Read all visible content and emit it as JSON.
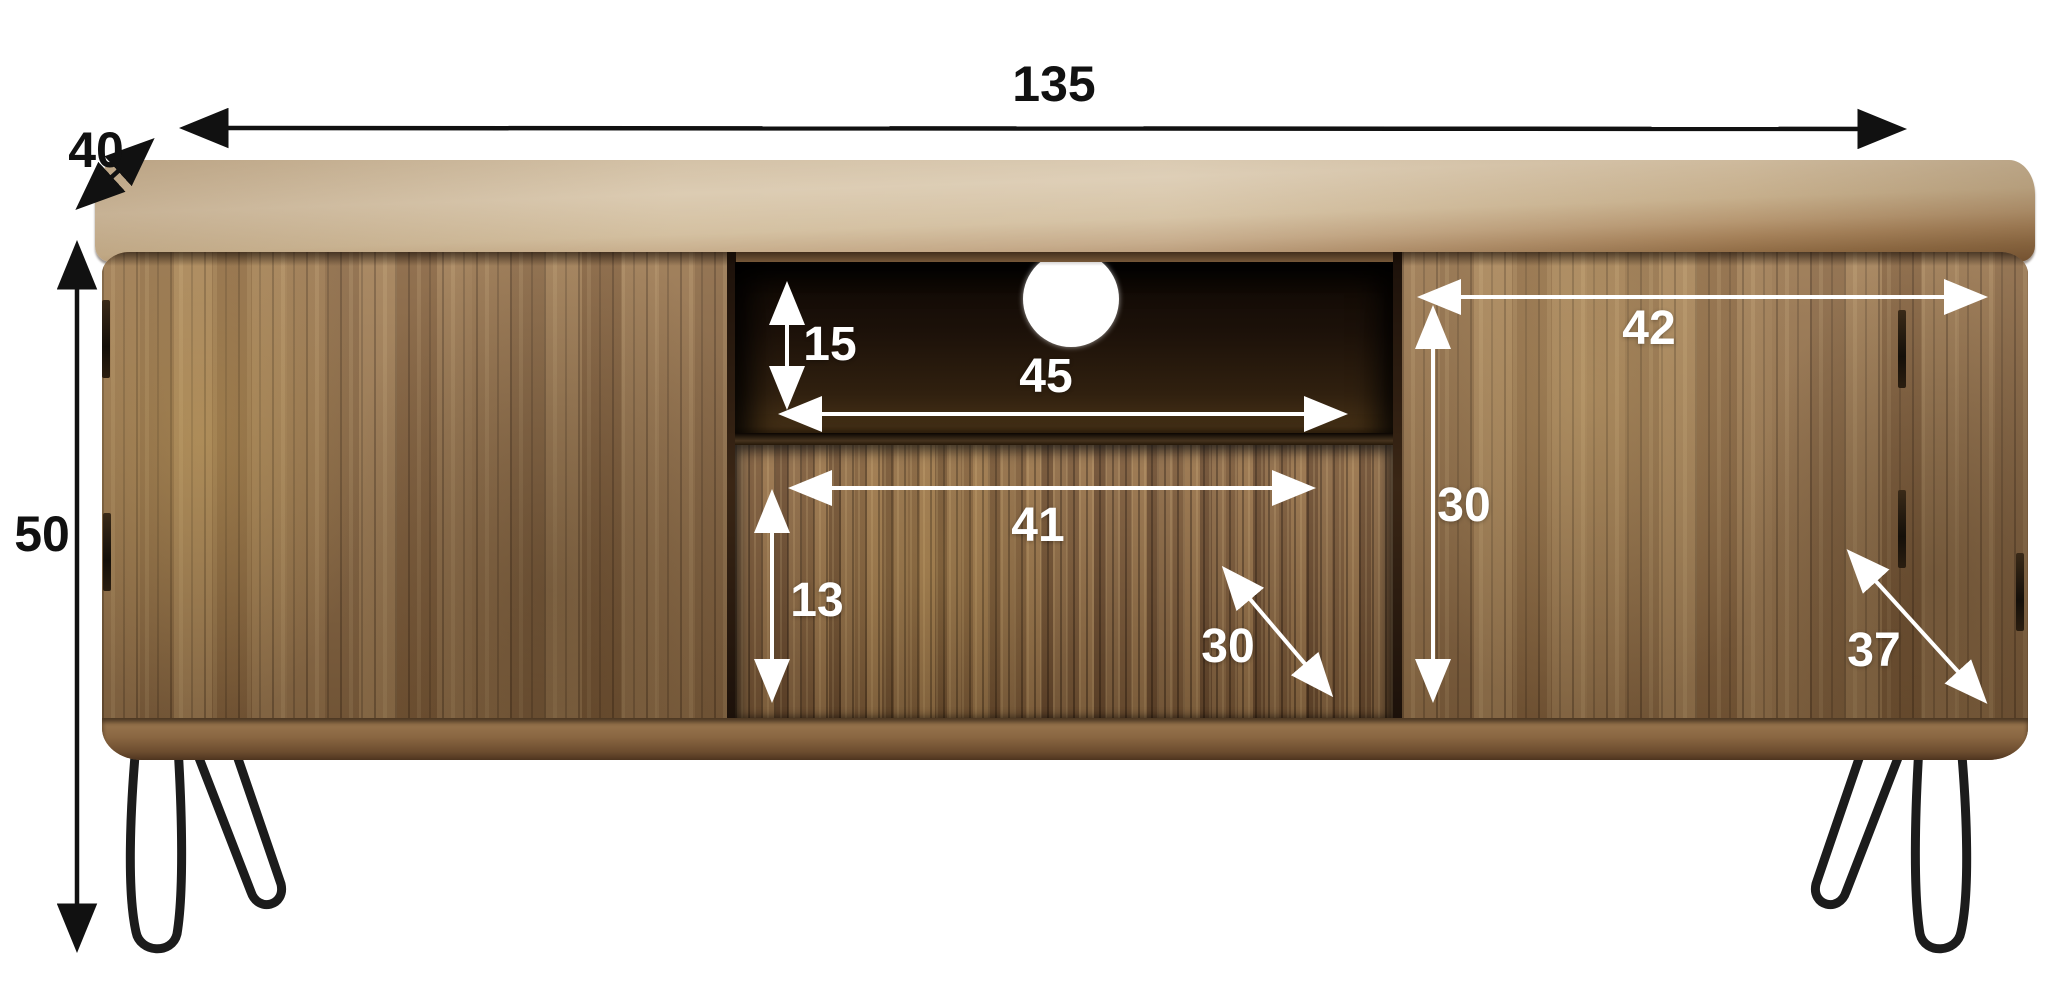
{
  "diagram": {
    "type": "furniture-dimension-diagram",
    "product": "tv-stand-with-two-doors-and-drawer"
  },
  "dimensions": {
    "total_width": "135",
    "total_depth": "40",
    "total_height": "50",
    "niche_height": "15",
    "niche_width": "45",
    "drawer_width": "41",
    "drawer_height": "13",
    "drawer_depth": "30",
    "right_door_width": "42",
    "right_door_height": "30",
    "right_door_diagonal": "37"
  },
  "colors": {
    "background": "#ffffff",
    "annotation_black": "#111111",
    "annotation_white": "#ffffff",
    "wood_top_light": "#d8c6aa",
    "wood_body": "#97734b",
    "niche_interior_dark": "#1c1109",
    "legs_metal": "#1c1c1c"
  }
}
